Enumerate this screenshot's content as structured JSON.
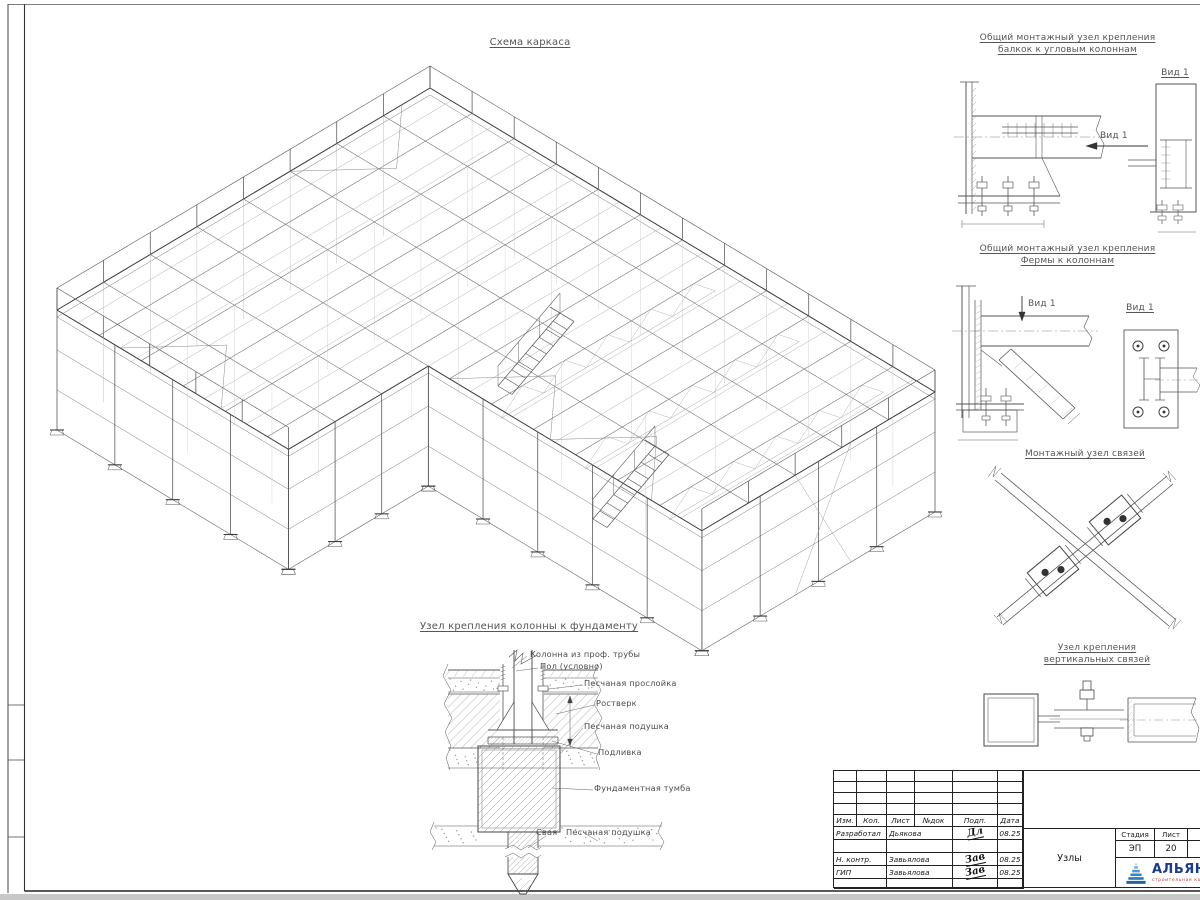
{
  "colors": {
    "line": "#555555",
    "logo_blue": "#2678b5",
    "logo_text": "#1d3b8f",
    "logo_sub_red": "#c23530"
  },
  "main_view": {
    "title": "Схема каркаса"
  },
  "details": {
    "view_label": "Вид 1",
    "d1": {
      "title_line1": "Общий монтажный узел крепления",
      "title_line2": "балкок к угловым колоннам"
    },
    "d2": {
      "title_line1": "Общий монтажный узел крепления",
      "title_line2": "Фермы к колоннам"
    },
    "d3": {
      "title": "Монтажный узел связей"
    },
    "d4": {
      "title_line1": "Узел крепления",
      "title_line2": "вертикальных связей"
    }
  },
  "foundation": {
    "title": "Узел крепления колонны к фундаменту",
    "labels": {
      "column": "Колонна из проф. трубы",
      "floor": "Пол (условно)",
      "sand_layer": "Песчаная прослойка",
      "grillage": "Ростверк",
      "sand_cushion": "Песчаная подушка",
      "grout": "Подливка",
      "pedestal": "Фундаментная тумба",
      "pile": "Свая",
      "sand_cushion2": "Песчаная подушка"
    }
  },
  "titleblock": {
    "headers": [
      "Изм.",
      "Кол.",
      "Лист",
      "№док",
      "Подп.",
      "Дата"
    ],
    "rows": [
      {
        "role": "Разработал",
        "name": "Дьякова",
        "sig": "Дл",
        "date": "08.25"
      },
      {
        "role": "",
        "name": "",
        "sig": "",
        "date": ""
      },
      {
        "role": "Н. контр.",
        "name": "Завьялова",
        "sig": "Зав",
        "date": "08.25"
      },
      {
        "role": "ГИП",
        "name": "Завьялова",
        "sig": "Зав",
        "date": "08.25"
      },
      {
        "role": "",
        "name": "",
        "sig": "",
        "date": ""
      }
    ],
    "stage_label": "Стадия",
    "sheet_label": "Лист",
    "sheets_label": "Листов",
    "stage": "ЭП",
    "sheet": "20",
    "sheets": "2",
    "doc_name": "Узлы",
    "company": "АЛЬЯНС",
    "company_sub": "строительная компания"
  }
}
